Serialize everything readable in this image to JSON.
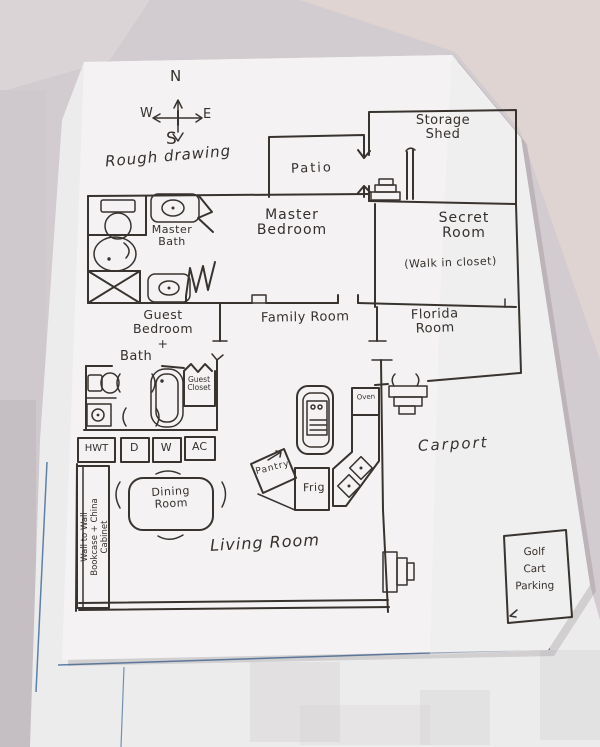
{
  "colors": {
    "ink": "#38332e",
    "paper": "#f4f2f3",
    "under_sheet": "#edecec",
    "table": "#d2cbcf",
    "table_warm": "#e0d5d2",
    "margin_blue": "#5d80a8"
  },
  "compass": {
    "n": "N",
    "w": "W",
    "e": "E",
    "s": "S"
  },
  "annotations": {
    "title": "Rough drawing"
  },
  "rooms": {
    "patio": "Patio",
    "storage_shed": "Storage\nShed",
    "master_bath": "Master\nBath",
    "master_bedroom": "Master\nBedroom",
    "secret_room": "Secret\nRoom",
    "secret_room_note": "(Walk in closet)",
    "family_room": "Family Room",
    "florida_room": "Florida\nRoom",
    "guest_bedroom": "Guest\nBedroom\n+",
    "guest_bath": "Bath",
    "guest_closet": "Guest\nCloset",
    "dining_room": "Dining\nRoom",
    "living_room": "Living Room",
    "carport": "Carport",
    "golf_cart_parking": "Golf\nCart\nParking"
  },
  "appliances": {
    "hwt": "HWT",
    "dryer": "D",
    "washer": "W",
    "ac": "AC",
    "oven": "Oven",
    "pantry": "Pantry",
    "fridge": "Frig"
  },
  "notes": {
    "bookcase": "Wall to Wall\nBookcase + China\nCabinet"
  },
  "icons": [
    "compass-rose-icon",
    "toilet-icon",
    "sink-icon",
    "bathtub-icon",
    "shower-icon",
    "stove-icon",
    "double-sink-icon",
    "steps-icon",
    "door-swing-icon",
    "dining-table-icon"
  ]
}
